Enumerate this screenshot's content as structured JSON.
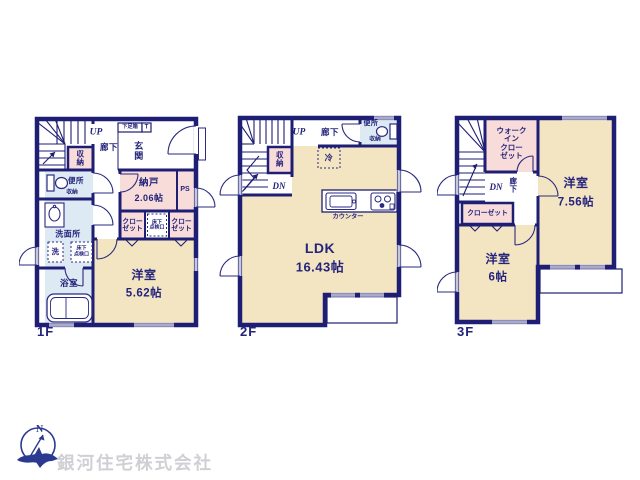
{
  "company": "銀河住宅株式会社",
  "compass": {
    "north": "N"
  },
  "colors": {
    "wall": "#1e1e74",
    "text": "#24247c",
    "room_cream": "#f4e5c2",
    "room_pink": "#f8dcda",
    "room_blue": "#dde9f3",
    "company_text": "#cfd0d4",
    "compass_blue": "#2b3990"
  },
  "floor1": {
    "name": "1F",
    "up": "UP",
    "hallway": "廊下",
    "shoe_box": "下足箱",
    "shoe_box_t": "T",
    "entrance": "玄\n関",
    "stair_storage": "収\n納",
    "toilet": "便所",
    "toilet_storage": "収納",
    "storeroom": "納戸",
    "storeroom_size": "2.06帖",
    "pipe_space": "PS",
    "closet_left": "クロー\nゼット",
    "closet_right": "クロー\nゼット",
    "floor_hatch_closet": "床下\n点検口",
    "washroom": "洗面所",
    "washer": "洗",
    "floor_hatch_wash": "床下\n点検口",
    "bath": "浴室",
    "bedroom": "洋室",
    "bedroom_size": "5.62帖"
  },
  "floor2": {
    "name": "2F",
    "up": "UP",
    "down": "DN",
    "stair_storage": "収\n納",
    "hallway": "廊下",
    "toilet": "便所",
    "toilet_storage": "収納",
    "fridge": "冷",
    "counter": "カウンター",
    "ldk": "LDK",
    "ldk_size": "16.43帖"
  },
  "floor3": {
    "name": "3F",
    "down": "DN",
    "hallway": "廊\n下",
    "walk_in_closet": "ウォーク\nイン\nクロー\nゼット",
    "closet": "クローゼット",
    "bedroom_a": "洋室",
    "bedroom_a_size": "7.56帖",
    "bedroom_b": "洋室",
    "bedroom_b_size": "6帖"
  }
}
